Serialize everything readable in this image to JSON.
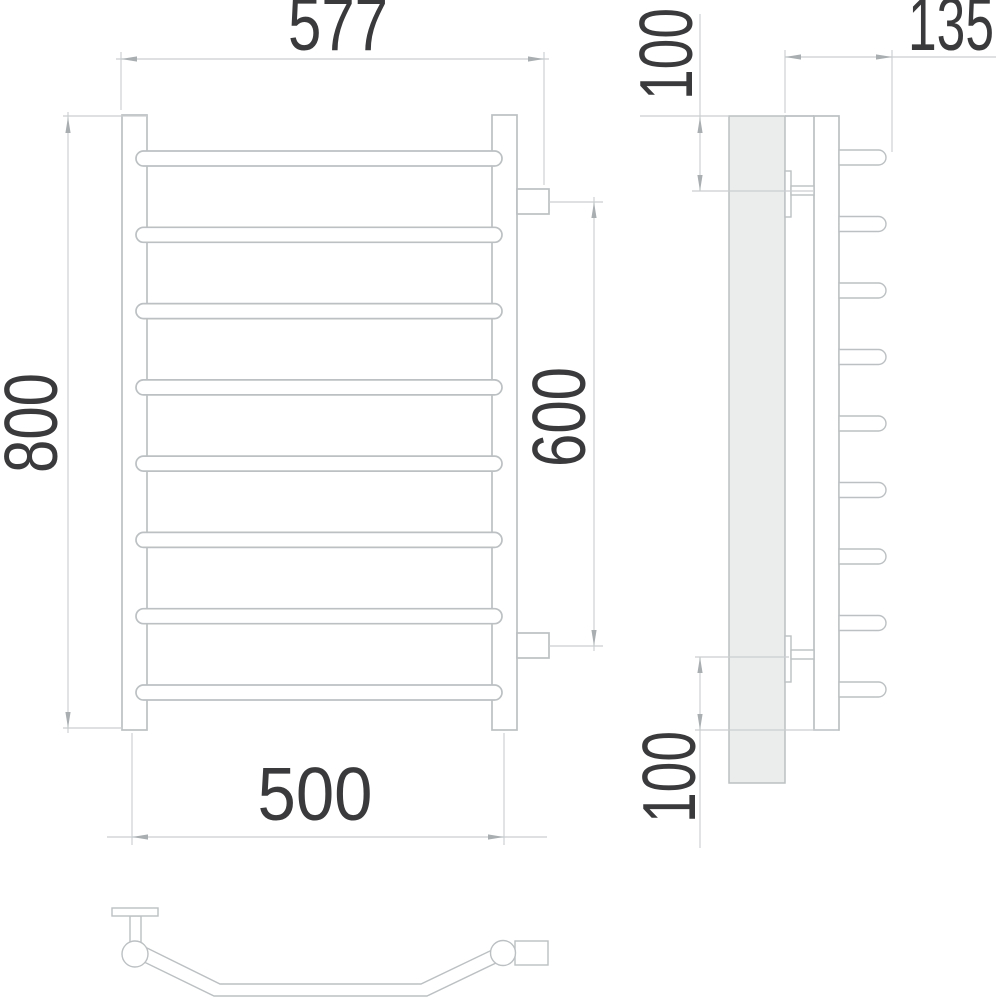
{
  "dims": {
    "overall_width": "577",
    "overall_height": "800",
    "connection_spacing": "600",
    "bottom_width": "500",
    "depth": "135",
    "top_offset": "100",
    "bottom_offset": "100"
  },
  "views": {
    "front_bar_count": 8,
    "side_bar_count": 9
  },
  "colors": {
    "line": "#bcc0c2",
    "dim_line": "#cbced0",
    "arrow": "#a9aeb1",
    "text": "#3a3a3c",
    "plate_fill": "#ebecec",
    "background": "#ffffff"
  }
}
